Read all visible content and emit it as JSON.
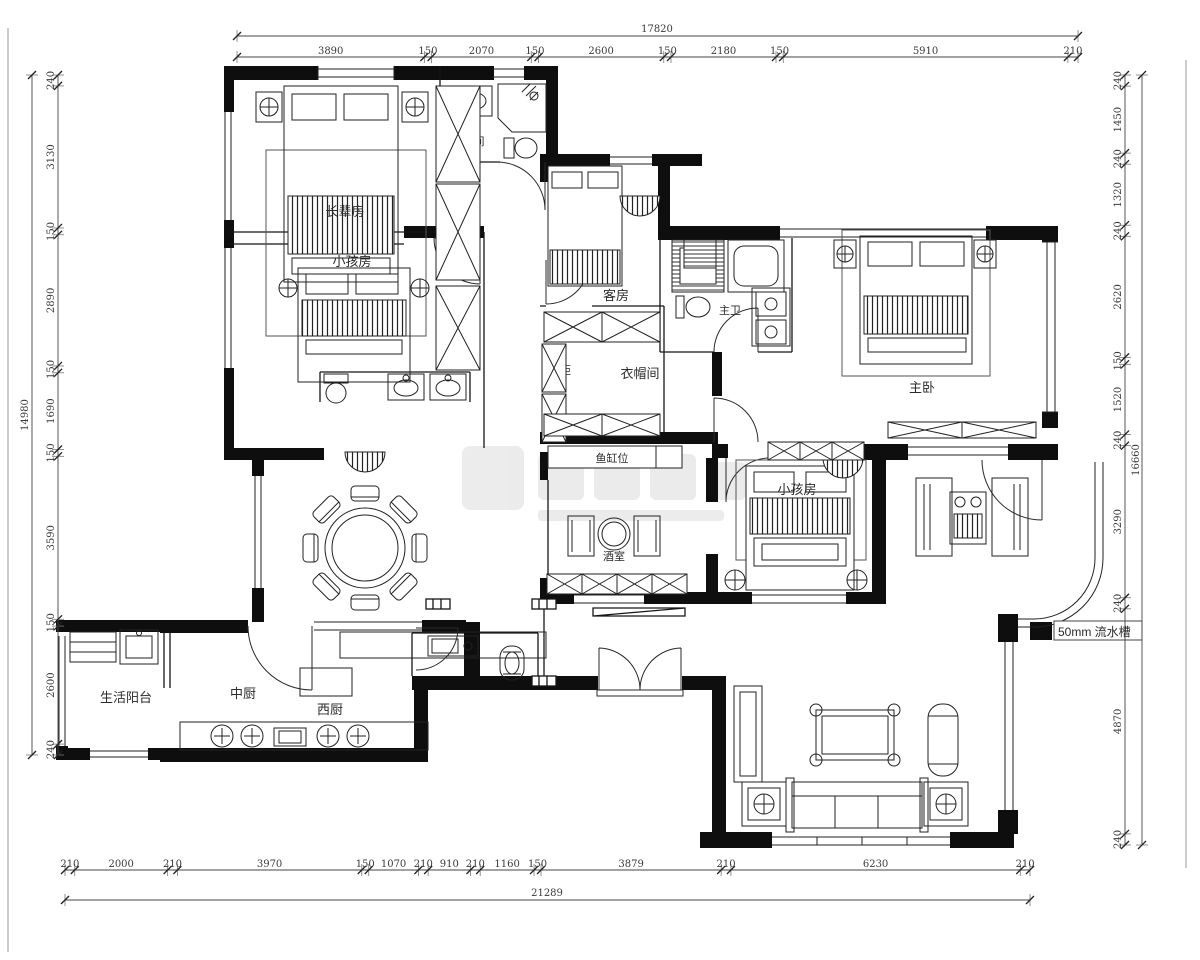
{
  "labels": {
    "elder_room": "长辈房",
    "kids_room_upper": "小孩房",
    "bathroom": "卫生间",
    "guest_room": "客房",
    "wardrobe_top": "衣柜",
    "shoe_cabinet": "鞋柜",
    "cloakroom": "衣帽间",
    "wardrobe_bottom": "衣柜",
    "master_bathroom": "主卫",
    "master_bedroom": "主卧",
    "fish_tank_spot": "鱼缸位",
    "wine_room": "酒室",
    "kids_room_lower": "小孩房",
    "dining_room": "餐厅",
    "utility_balcony": "生活阳台",
    "chinese_kitchen": "中厨",
    "western_kitchen": "西厨",
    "drain_note": "50mm 流水槽"
  },
  "dimensions": {
    "top": {
      "total": "17820",
      "segments": [
        3890,
        150,
        2070,
        150,
        2600,
        150,
        2180,
        150,
        5910,
        210
      ]
    },
    "bottom": {
      "total": "21289",
      "segments": [
        210,
        2000,
        210,
        3970,
        150,
        1070,
        210,
        910,
        210,
        1160,
        150,
        3879,
        210,
        6230,
        210
      ]
    },
    "left": {
      "total": "14980",
      "segments": [
        240,
        3130,
        150,
        2890,
        150,
        1690,
        150,
        3590,
        150,
        2600,
        240
      ]
    },
    "right": {
      "total": "16660",
      "segments": [
        240,
        1450,
        240,
        1320,
        240,
        2620,
        150,
        1520,
        240,
        3290,
        240,
        4870,
        240
      ]
    }
  }
}
